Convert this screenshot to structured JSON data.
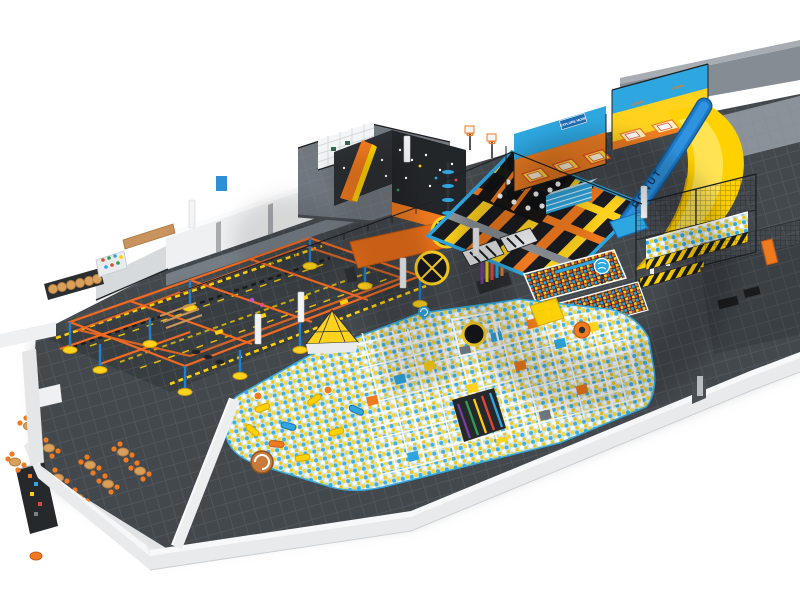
{
  "signage": {
    "urban_logo": "URBAN",
    "urban_logo_2": "URBAN",
    "explore_more_banner": "EXPLORE MORE",
    "donut_slide_text": "DONUT"
  },
  "palette": {
    "background": "#ffffff",
    "floor_dark": "#43484d",
    "floor_grid_line": "#5a6066",
    "wall_white": "#f1f2f3",
    "accent_yellow": "#ffd21e",
    "accent_orange": "#f07a1f",
    "accent_blue": "#2ea7e0",
    "slide_blue": "#1e7ac8",
    "trampoline_bed_black": "#17191c",
    "ball_pit_base": "#cfe8f3",
    "cafe_chair_orange": "#f07a1f",
    "table_wood": "#d9a05b"
  },
  "facility": {
    "zones": [
      "cafe-seating",
      "vending-counter",
      "ninja-warrior-course",
      "interactive-peg-board",
      "climbing-walls",
      "mezzanine-cafe-deck",
      "wrecking-ball-targets",
      "pole-forest",
      "main-trampoline-court",
      "dunk-hoops",
      "launch-ramps",
      "stunt-jump-platforms",
      "performance-trampoline-court",
      "donut-slide",
      "wave-slide",
      "spacenet-mezzanine",
      "ball-tube-bridge",
      "foam-cube-pits",
      "ball-pit",
      "soft-play-maze",
      "pyramid-tower",
      "rainbow-slide",
      "spiral-slide",
      "donut-trampoline",
      "windows-wall",
      "back-rooms"
    ],
    "counts": {
      "cafe_tables": 9,
      "chairs_per_table": 4,
      "stunt_jump_beds": 3,
      "performance_court_beds": 3,
      "foam_cube_pits": 2,
      "climbing_walls": 2,
      "wrecking_ball_targets": 2
    }
  }
}
